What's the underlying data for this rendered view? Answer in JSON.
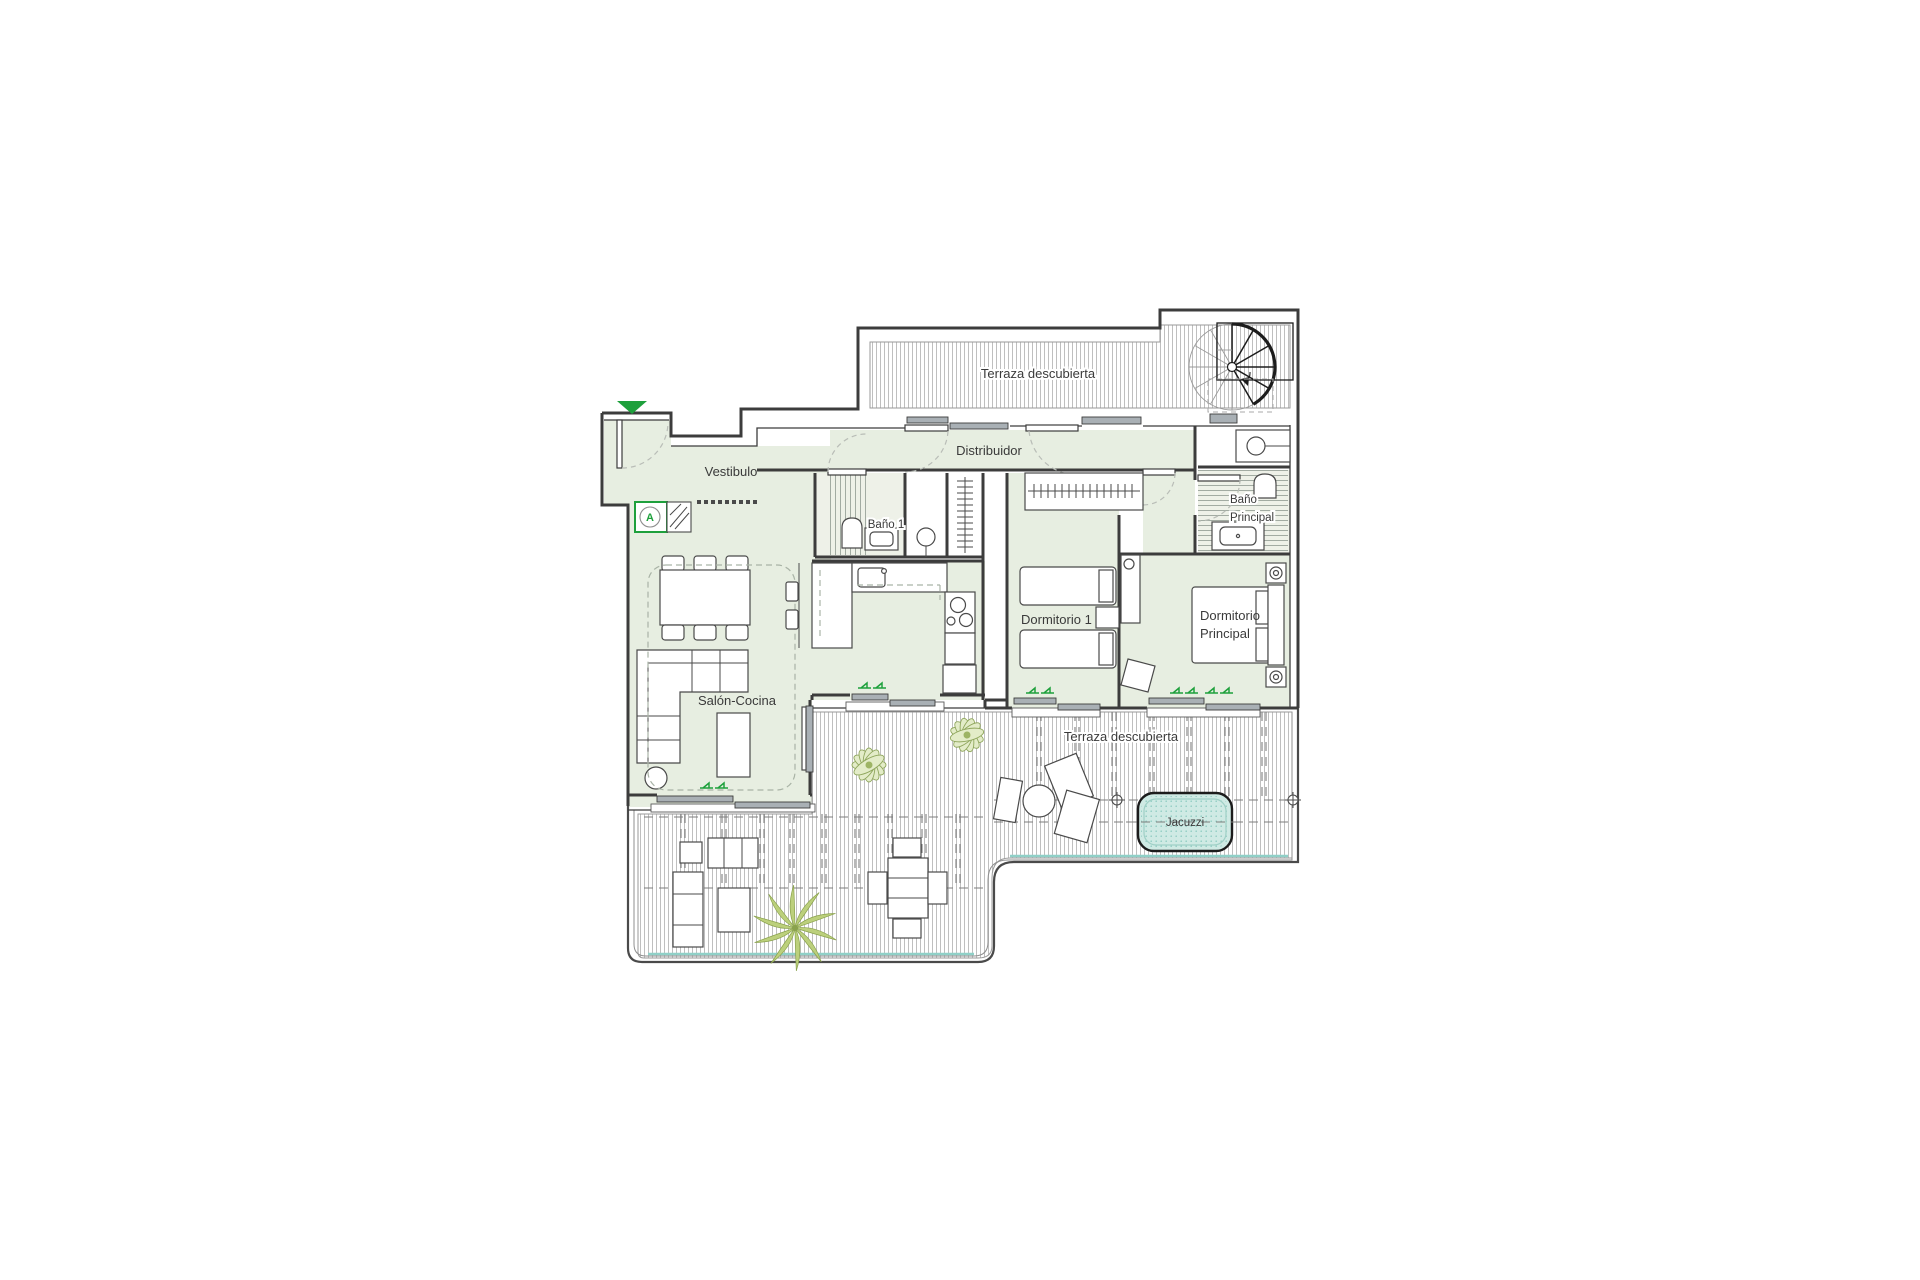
{
  "floor_plan": {
    "labels": {
      "terraza_superior": "Terraza descubierta",
      "vestibulo": "Vestibulo",
      "distribuidor": "Distribuidor",
      "bano1": "Baño 1",
      "bano_principal_line1": "Baño",
      "bano_principal_line2": "Principal",
      "dormitorio1": "Dormitorio 1",
      "dormitorio_principal_line1": "Dormitorio",
      "dormitorio_principal_line2": "Principal",
      "salon_cocina": "Salón-Cocina",
      "terraza_inferior": "Terraza descubierta",
      "jacuzzi": "Jacuzzi",
      "entrance_unit": "A"
    },
    "colors": {
      "interior": "#e7eee1",
      "wall": "#3c3c3c",
      "deck_line": "#b8b8b8",
      "accent": "#1ea03c",
      "jacuzzi_fill": "#cfeae4",
      "glass": "#8fd0c7",
      "plant_olive": "#8fa65c"
    }
  }
}
